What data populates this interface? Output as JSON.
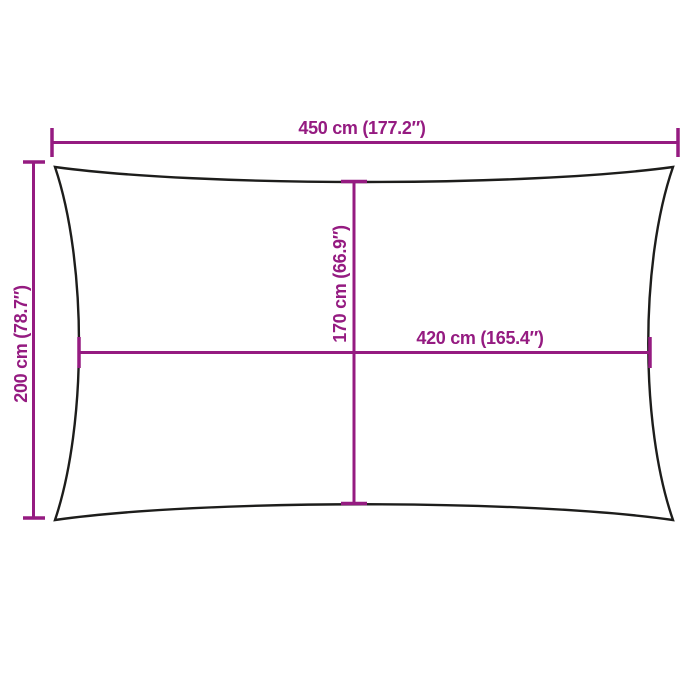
{
  "colors": {
    "accent": "#951b81",
    "outline": "#1d1d1b",
    "bg": "#ffffff"
  },
  "diagram": {
    "kind": "rectangular shade sail dimension drawing"
  },
  "dimensions": {
    "outer_width": {
      "label": "450 cm (177.2″)",
      "cm": 450,
      "inches": 177.2,
      "orientation": "horizontal-top"
    },
    "outer_height": {
      "label": "200 cm (78.7″)",
      "cm": 200,
      "inches": 78.7,
      "orientation": "vertical-left"
    },
    "inner_height": {
      "label": "170 cm (66.9″)",
      "cm": 170,
      "inches": 66.9,
      "orientation": "vertical-center"
    },
    "inner_width": {
      "label": "420 cm (165.4″)",
      "cm": 420,
      "inches": 165.4,
      "orientation": "horizontal-center"
    }
  }
}
